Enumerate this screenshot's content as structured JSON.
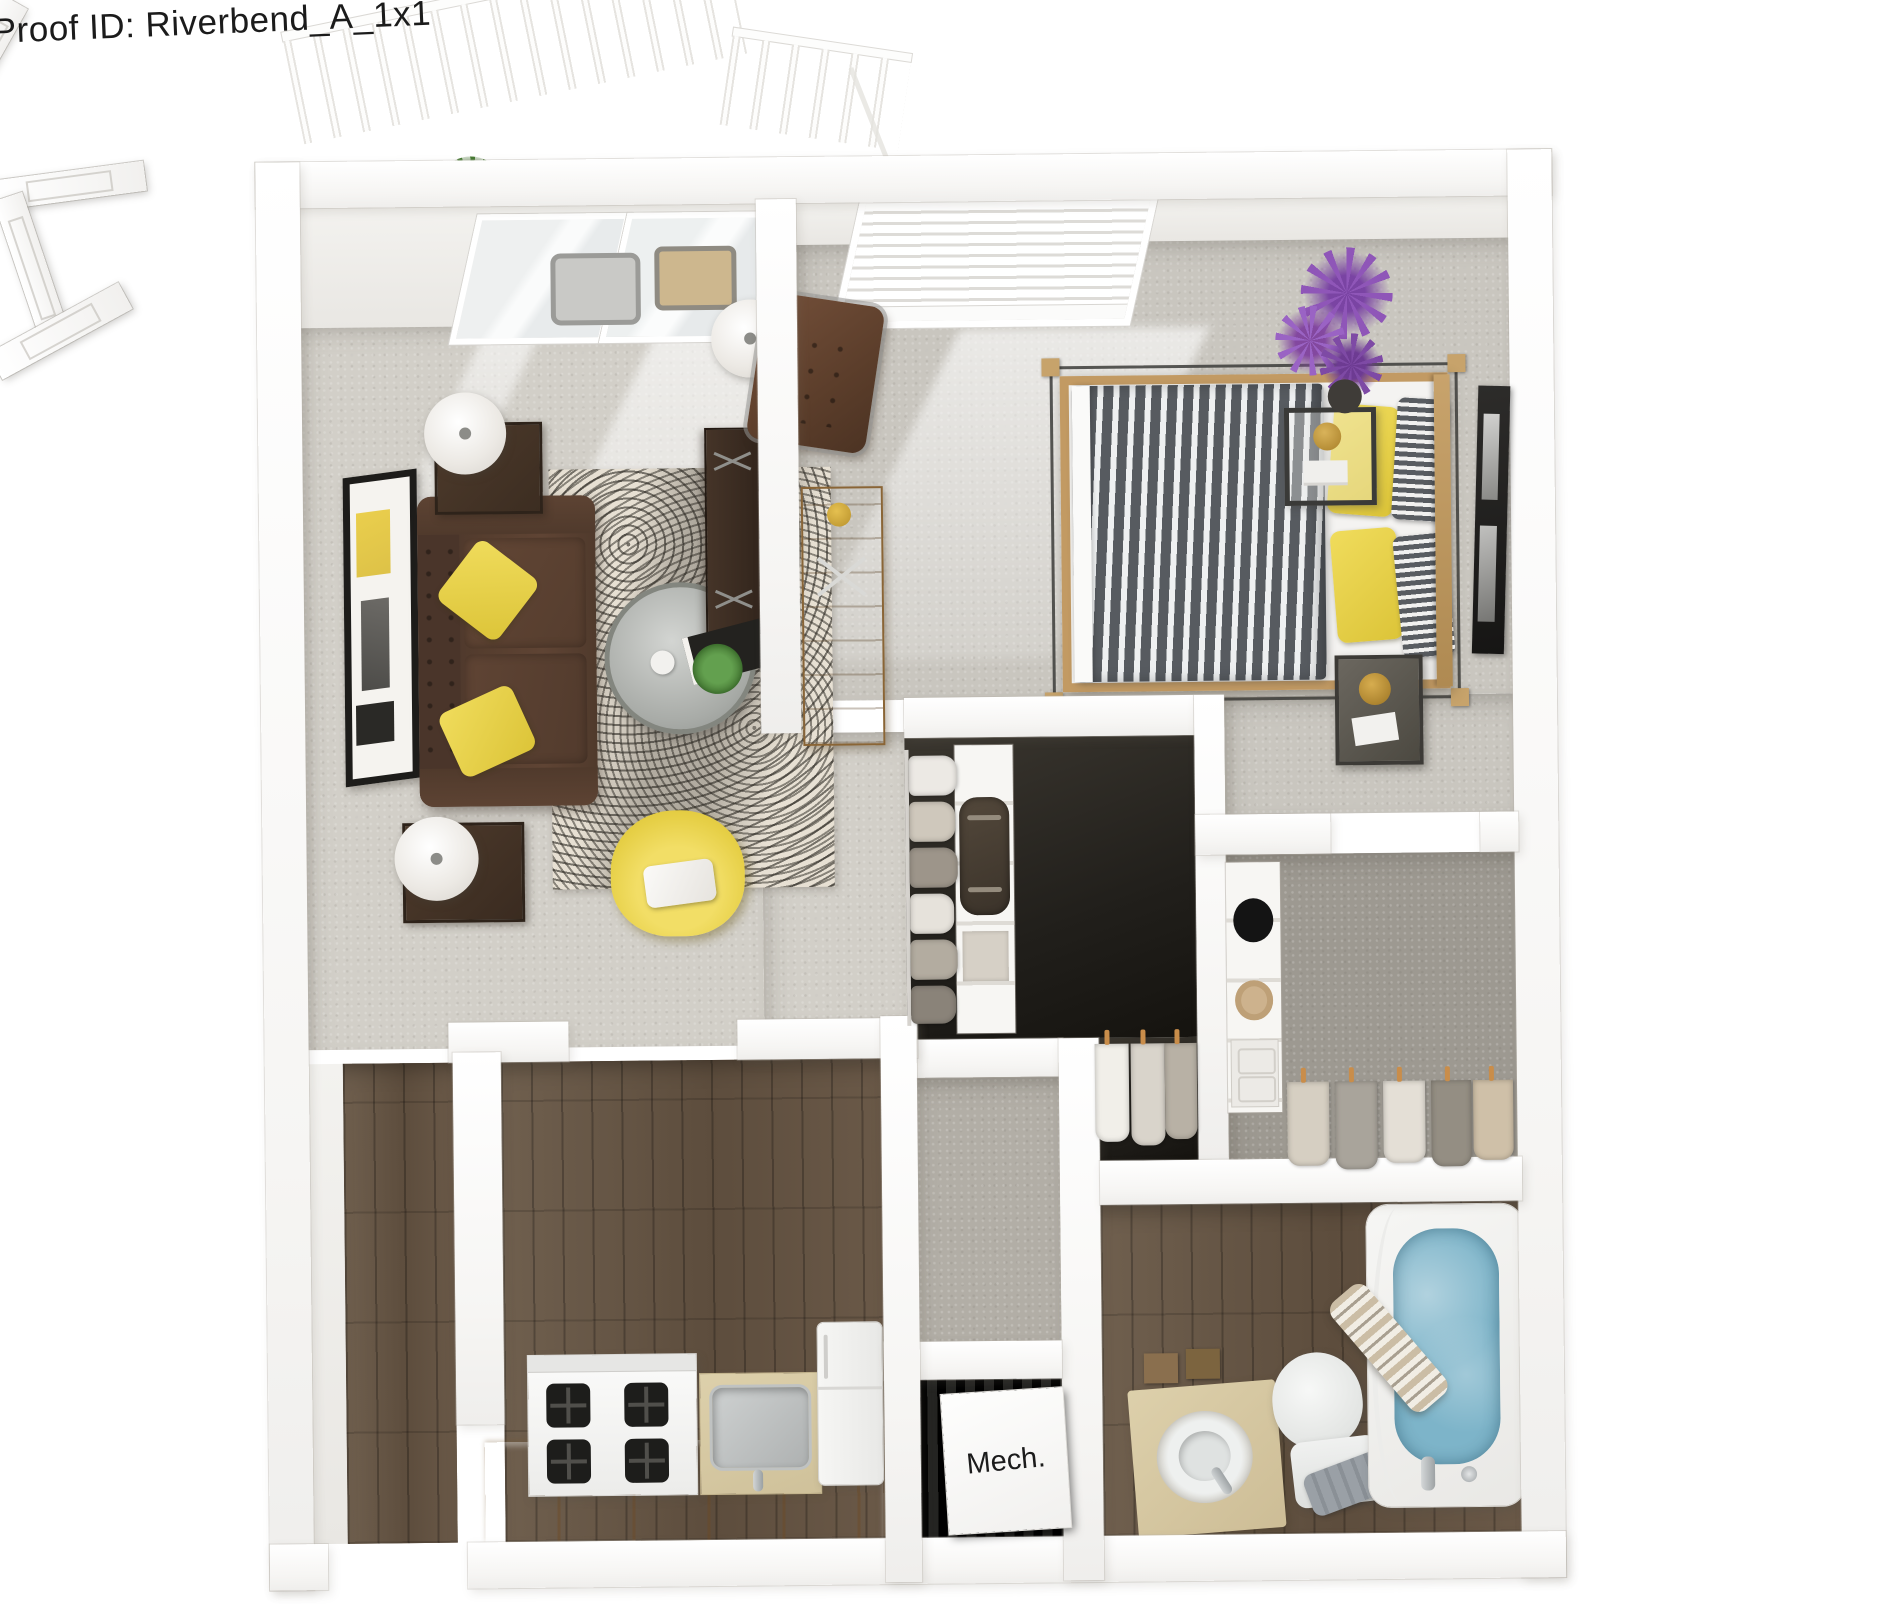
{
  "proof": {
    "label": "Proof ID: Riverbend_A_1x1"
  },
  "rooms": {
    "mech": {
      "label": "Mech."
    },
    "list": [
      "balcony",
      "living-room",
      "bedroom",
      "reach-in-closet",
      "walk-in-closet",
      "hallway",
      "bathroom",
      "mechanical-closet",
      "kitchen",
      "entry"
    ]
  },
  "palette": {
    "background": "#ffffff",
    "wall": "#ffffff",
    "carpet_living": "#d2cfc8",
    "carpet_bedroom": "#c9c6bf",
    "carpet_walk_in": "#9d9991",
    "wood_floor": "#685847",
    "closet_floor": "#211f1b",
    "mech_floor": "#141413",
    "accent_yellow": "#e8d24e",
    "sofa_brown": "#543c2e",
    "leather_chair": "#6d4733",
    "bed_stripe_gray": "#585c61",
    "bed_frame_wood": "#c29a63",
    "tub_water": "#7db4c9",
    "cabinet_tan": "#d9ba8c",
    "counter_beige": "#d9cba6",
    "plant_green": "#4d7f37",
    "flower_purple": "#8f56b8"
  }
}
